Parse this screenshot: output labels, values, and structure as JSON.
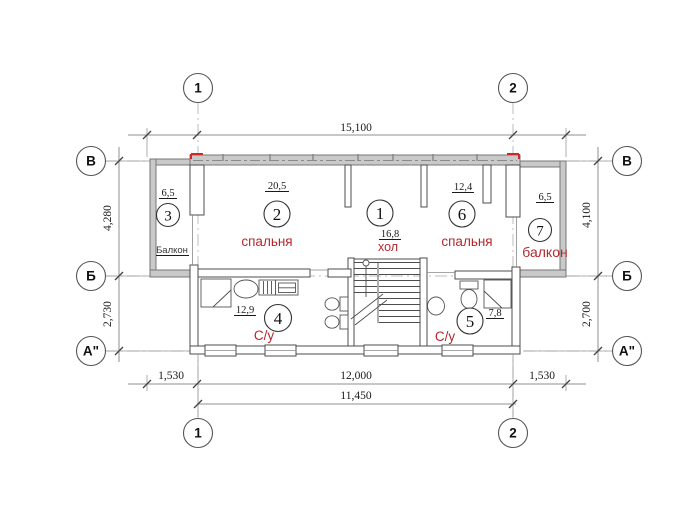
{
  "grid": {
    "col1": "1",
    "col2": "2",
    "rowB": "В",
    "rowBm": "Б",
    "rowA": "А\""
  },
  "dims": {
    "top": "15,100",
    "left_upper": "4,280",
    "left_lower": "2,730",
    "right_upper": "4,100",
    "right_lower": "2,700",
    "bottom_left": "1,530",
    "bottom_mid": "12,000",
    "bottom_right": "1,530",
    "bottom_inner": "11,450"
  },
  "rooms": {
    "r1": {
      "num": "1",
      "area": "16,8",
      "label": "хол"
    },
    "r2": {
      "num": "2",
      "area": "20,5",
      "label": "спальня"
    },
    "r3": {
      "num": "3",
      "area": "6,5",
      "label": "Балкон"
    },
    "r4": {
      "num": "4",
      "area": "12,9",
      "label": "С/у"
    },
    "r5": {
      "num": "5",
      "area": "7,8",
      "label": "С/у"
    },
    "r6": {
      "num": "6",
      "area": "12,4",
      "label": "спальня"
    },
    "r7": {
      "num": "7",
      "area": "6,5",
      "label": "балкон"
    }
  },
  "colors": {
    "red": "#b5282c",
    "wall_fill": "#c9c9c9",
    "line": "#4d4d4d"
  }
}
